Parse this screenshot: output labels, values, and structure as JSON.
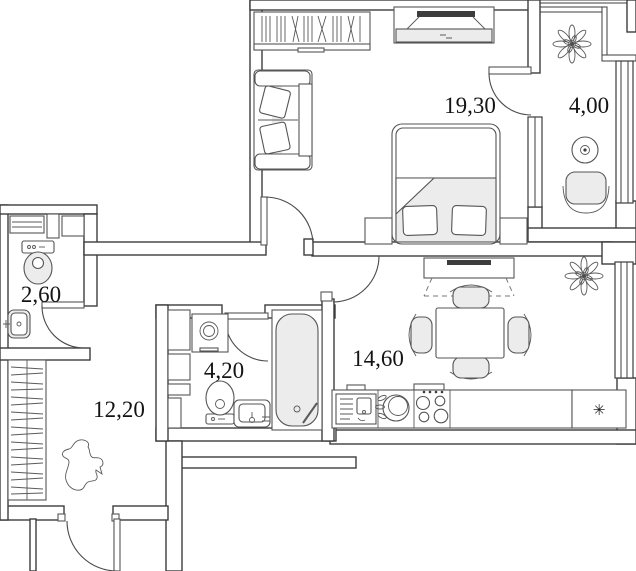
{
  "floor_plan": {
    "room_labels": {
      "bedroom": "19,30",
      "balcony": "4,00",
      "toilet": "2,60",
      "bathroom": "4,20",
      "hallway": "12,20",
      "kitchen": "14,60"
    },
    "symbols": {
      "fridge_snowflake": "✳"
    }
  }
}
